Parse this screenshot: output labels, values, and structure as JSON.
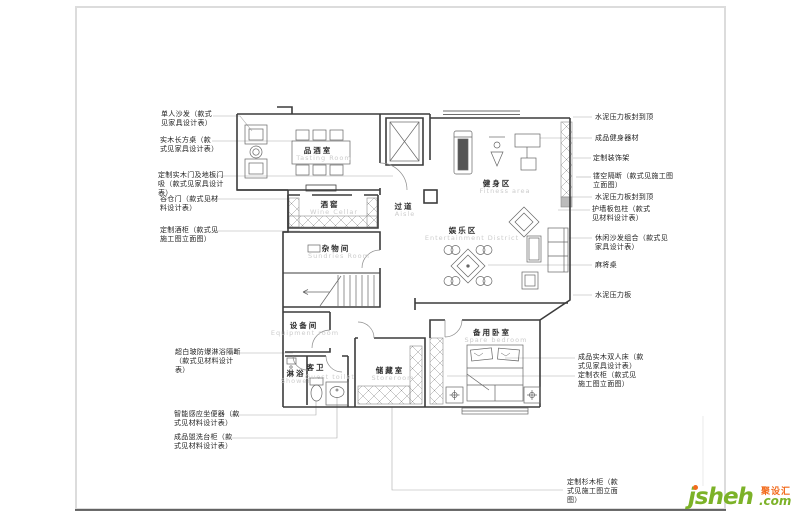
{
  "document": {
    "type": "residential floor plan working drawing"
  },
  "rooms": [
    {
      "zh": "品酒室",
      "en": "Tasting Room"
    },
    {
      "zh": "酒窖",
      "en": "Wine Cellar"
    },
    {
      "zh": "过道",
      "en": "Aisle"
    },
    {
      "zh": "健身区",
      "en": "Fitness area"
    },
    {
      "zh": "娱乐区",
      "en": "Entertainment District"
    },
    {
      "zh": "杂物间",
      "en": "Sundries Room"
    },
    {
      "zh": "设备间",
      "en": "Equipment room"
    },
    {
      "zh": "淋浴",
      "en": "Shower"
    },
    {
      "zh": "客卫",
      "en": "Guest toilet"
    },
    {
      "zh": "储藏室",
      "en": "Storeroom"
    },
    {
      "zh": "备用卧室",
      "en": "Spare bedroom"
    }
  ],
  "left_callouts": [
    {
      "text": "单人沙发（款式\n见家具设计表）"
    },
    {
      "text": "实木长方桌（款\n式见家具设计表）"
    },
    {
      "text": "定制实木门及地板门\n吸（款式见家具设计\n表）"
    },
    {
      "text": "谷仓门（款式见材\n料设计表）"
    },
    {
      "text": "定制酒柜（款式见\n施工图立面图）"
    },
    {
      "text": "超白玻防爆淋浴隔断\n（款式见材料设计\n表）"
    },
    {
      "text": "智能感应坐便器（款\n式见材料设计表）"
    },
    {
      "text": "成品盥洗台柜（款\n式见材料设计表）"
    }
  ],
  "right_callouts": [
    {
      "text": "水泥压力板封到顶"
    },
    {
      "text": "成品健身器材"
    },
    {
      "text": "定制装饰架"
    },
    {
      "text": "镂空隔断（款式见施工图\n立面图）"
    },
    {
      "text": "水泥压力板封到顶"
    },
    {
      "text": "护墙板包柱（款式\n见材料设计表）"
    },
    {
      "text": "休闲沙发组合（款式见\n家具设计表）"
    },
    {
      "text": "麻将桌"
    },
    {
      "text": "水泥压力板"
    },
    {
      "text": "成品实木双人床（款\n式见家具设计表）"
    },
    {
      "text": "定制衣柜（款式见\n施工图立面图）"
    }
  ],
  "bottom_callout": {
    "text": "定制杉木柜（款\n式见施工图立面\n图）"
  },
  "logo": {
    "brand": "jsheh",
    "zh": "聚设汇",
    "suffix": ".com"
  },
  "colors": {
    "wall": "#3c3c3c",
    "leader": "#aaaaaa",
    "room_label_en": "#cccccc",
    "logo_green": "#7cb228",
    "logo_orange": "#f26b1d",
    "frame": "#dcdcdc"
  }
}
